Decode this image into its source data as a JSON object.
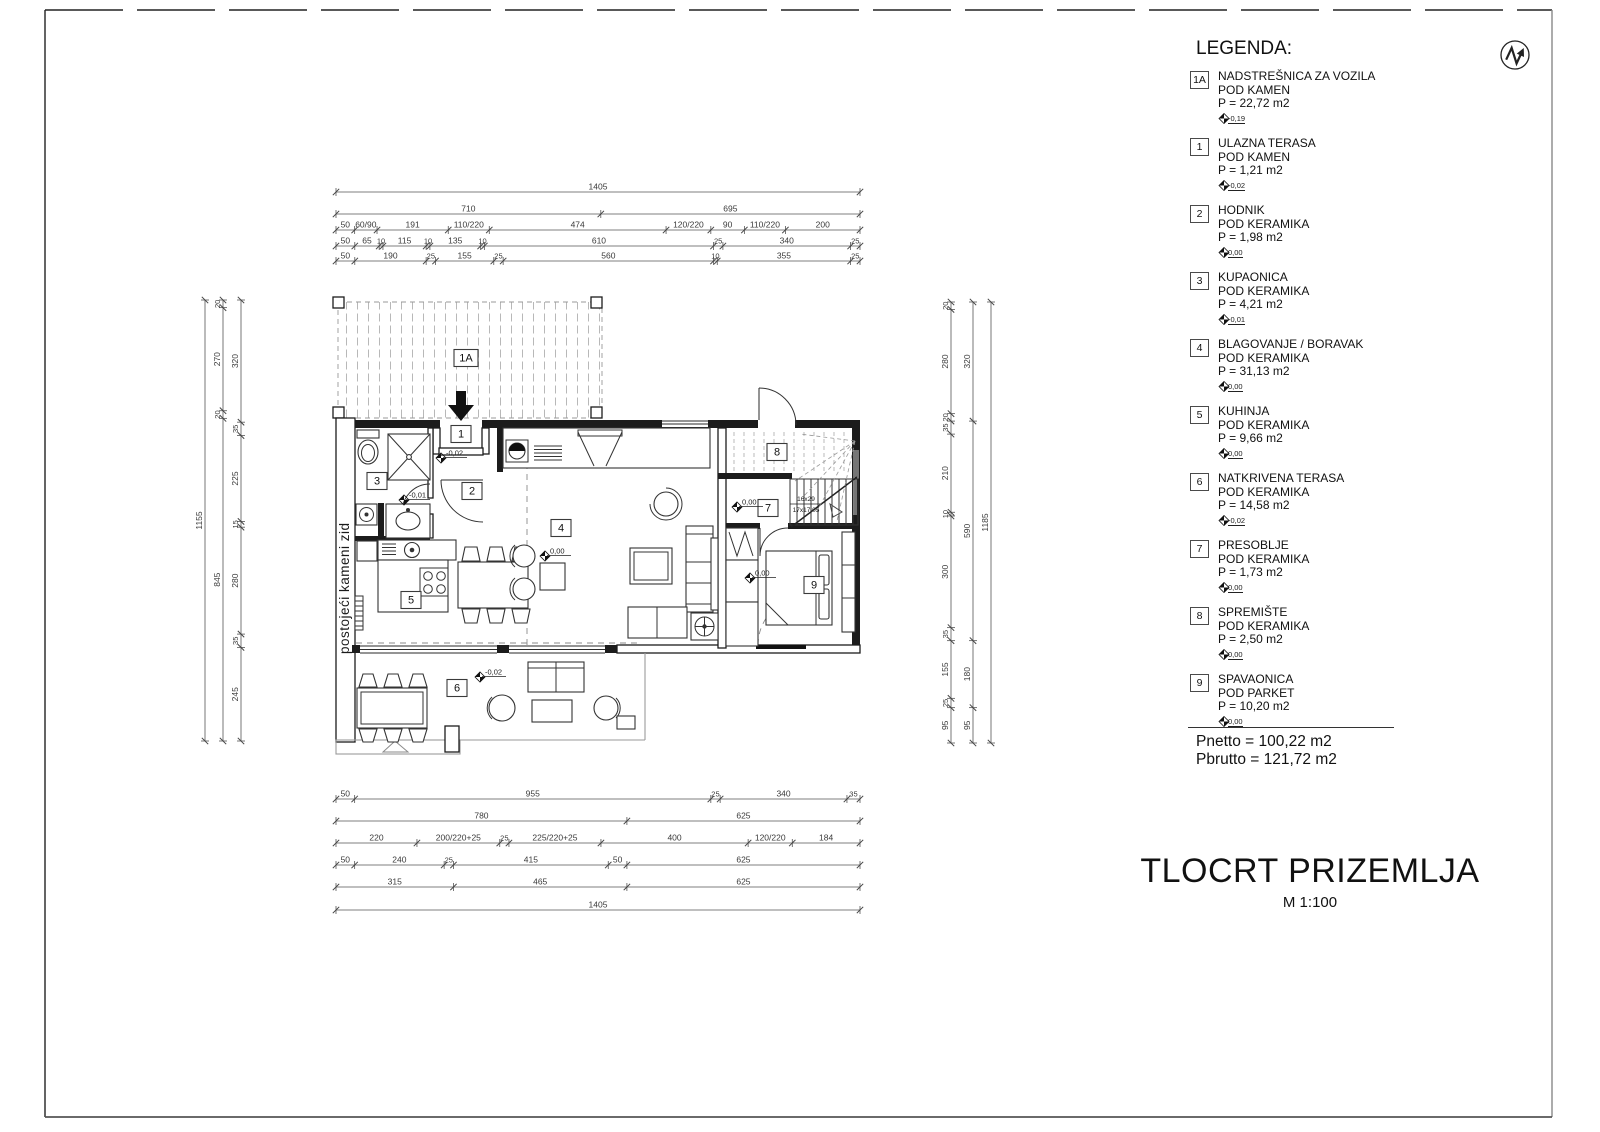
{
  "sheet": {
    "title": "TLOCRT PRIZEMLJA",
    "scale_label": "M 1:100"
  },
  "legend": {
    "heading": "LEGENDA:",
    "entries": [
      {
        "id": "1A",
        "name": "NADSTREŠNICA ZA VOZILA",
        "floor": "POD KAMEN",
        "area": "P = 22,72 m2",
        "elevation": "-0,19"
      },
      {
        "id": "1",
        "name": "ULAZNA TERASA",
        "floor": "POD KAMEN",
        "area": "P = 1,21 m2",
        "elevation": "-0,02"
      },
      {
        "id": "2",
        "name": "HODNIK",
        "floor": "POD KERAMIKA",
        "area": "P = 1,98 m2",
        "elevation": "0,00"
      },
      {
        "id": "3",
        "name": "KUPAONICA",
        "floor": "POD KERAMIKA",
        "area": "P = 4,21 m2",
        "elevation": "-0,01"
      },
      {
        "id": "4",
        "name": "BLAGOVANJE / BORAVAK",
        "floor": "POD KERAMIKA",
        "area": "P = 31,13 m2",
        "elevation": "0,00"
      },
      {
        "id": "5",
        "name": "KUHINJA",
        "floor": "POD KERAMIKA",
        "area": "P = 9,66 m2",
        "elevation": "0,00"
      },
      {
        "id": "6",
        "name": "NATKRIVENA TERASA",
        "floor": "POD KERAMIKA",
        "area": "P = 14,58 m2",
        "elevation": "-0,02"
      },
      {
        "id": "7",
        "name": "PRESOBLJE",
        "floor": "POD KERAMIKA",
        "area": "P = 1,73 m2",
        "elevation": "0,00"
      },
      {
        "id": "8",
        "name": "SPREMIŠTE",
        "floor": "POD KERAMIKA",
        "area": "P = 2,50 m2",
        "elevation": "0,00"
      },
      {
        "id": "9",
        "name": "SPAVAONICA",
        "floor": "POD PARKET",
        "area": "P = 10,20 m2",
        "elevation": "0,00"
      }
    ],
    "totals": {
      "net": "Pnetto = 100,22 m2",
      "gross": "Pbrutto = 121,72 m2"
    }
  },
  "plan": {
    "wall_note": "postojeći kameni zid",
    "stair_note_line1": "16x29",
    "stair_note_line2": "17x17,05",
    "rooms": [
      {
        "id": "1A"
      },
      {
        "id": "1"
      },
      {
        "id": "2"
      },
      {
        "id": "3"
      },
      {
        "id": "4"
      },
      {
        "id": "5"
      },
      {
        "id": "6"
      },
      {
        "id": "7"
      },
      {
        "id": "8"
      },
      {
        "id": "9"
      }
    ],
    "elevations": [
      {
        "label": "-0,02"
      },
      {
        "label": "-0,01"
      },
      {
        "label": "0,00"
      },
      {
        "label": "0,00"
      },
      {
        "label": "0,00"
      },
      {
        "label": "-0,02"
      }
    ]
  },
  "dimensions": {
    "top": [
      {
        "segments": [
          {
            "len": 1405,
            "label": "1405"
          }
        ]
      },
      {
        "segments": [
          {
            "len": 710,
            "label": "710"
          },
          {
            "len": 695,
            "label": "695"
          }
        ]
      },
      {
        "segments": [
          {
            "len": 50,
            "label": "50"
          },
          {
            "len": 60,
            "label": "60/90"
          },
          {
            "len": 191,
            "label": "191"
          },
          {
            "len": 110,
            "label": "110/220"
          },
          {
            "len": 474,
            "label": "474"
          },
          {
            "len": 120,
            "label": "120/220"
          },
          {
            "len": 90,
            "label": "90"
          },
          {
            "len": 110,
            "label": "110/220"
          },
          {
            "len": 200,
            "label": "200"
          }
        ]
      },
      {
        "segments": [
          {
            "len": 50,
            "label": "50"
          },
          {
            "len": 65,
            "label": "65"
          },
          {
            "len": 10,
            "label": "10"
          },
          {
            "len": 115,
            "label": "115"
          },
          {
            "len": 10,
            "label": "10"
          },
          {
            "len": 135,
            "label": "135"
          },
          {
            "len": 10,
            "label": "10"
          },
          {
            "len": 610,
            "label": "610"
          },
          {
            "len": 25,
            "label": "25"
          },
          {
            "len": 340,
            "label": "340"
          },
          {
            "len": 25,
            "label": "25"
          }
        ]
      },
      {
        "segments": [
          {
            "len": 50,
            "label": "50"
          },
          {
            "len": 190,
            "label": "190"
          },
          {
            "len": 25,
            "label": "25"
          },
          {
            "len": 155,
            "label": "155"
          },
          {
            "len": 25,
            "label": "25"
          },
          {
            "len": 560,
            "label": "560"
          },
          {
            "len": 10,
            "label": "10"
          },
          {
            "len": 355,
            "label": "355"
          },
          {
            "len": 25,
            "label": "25"
          }
        ]
      }
    ],
    "bottom": [
      {
        "segments": [
          {
            "len": 50,
            "label": "50"
          },
          {
            "len": 955,
            "label": "955"
          },
          {
            "len": 25,
            "label": "25"
          },
          {
            "len": 340,
            "label": "340"
          },
          {
            "len": 35,
            "label": "35"
          }
        ]
      },
      {
        "segments": [
          {
            "len": 780,
            "label": "780"
          },
          {
            "len": 625,
            "label": "625"
          }
        ]
      },
      {
        "segments": [
          {
            "len": 220,
            "label": "220"
          },
          {
            "len": 225,
            "label": "200/220+25"
          },
          {
            "len": 25,
            "label": "25"
          },
          {
            "len": 250,
            "label": "225/220+25"
          },
          {
            "len": 400,
            "label": "400"
          },
          {
            "len": 120,
            "label": "120/220"
          },
          {
            "len": 184,
            "label": "184"
          }
        ]
      },
      {
        "segments": [
          {
            "len": 50,
            "label": "50"
          },
          {
            "len": 240,
            "label": "240"
          },
          {
            "len": 25,
            "label": "25"
          },
          {
            "len": 415,
            "label": "415"
          },
          {
            "len": 50,
            "label": "50"
          },
          {
            "len": 625,
            "label": "625"
          }
        ]
      },
      {
        "segments": [
          {
            "len": 315,
            "label": "315"
          },
          {
            "len": 465,
            "label": "465"
          },
          {
            "len": 625,
            "label": "625"
          }
        ]
      },
      {
        "segments": [
          {
            "len": 1405,
            "label": "1405"
          }
        ]
      }
    ],
    "left": [
      {
        "segments": [
          {
            "len": 1155,
            "label": "1155"
          }
        ]
      },
      {
        "segments": [
          {
            "len": 20,
            "label": "20"
          },
          {
            "len": 270,
            "label": "270"
          },
          {
            "len": 20,
            "label": "20"
          },
          {
            "len": 845,
            "label": "845"
          }
        ]
      },
      {
        "segments": [
          {
            "len": 320,
            "label": "320"
          },
          {
            "len": 35,
            "label": "35"
          },
          {
            "len": 225,
            "label": "225"
          },
          {
            "len": 15,
            "label": "15"
          },
          {
            "len": 280,
            "label": "280"
          },
          {
            "len": 35,
            "label": "35"
          },
          {
            "len": 245,
            "label": "245"
          }
        ]
      }
    ],
    "right": [
      {
        "segments": [
          {
            "len": 20,
            "label": "20"
          },
          {
            "len": 280,
            "label": "280"
          },
          {
            "len": 20,
            "label": "20"
          },
          {
            "len": 35,
            "label": "35"
          },
          {
            "len": 210,
            "label": "210"
          },
          {
            "len": 10,
            "label": "10"
          },
          {
            "len": 300,
            "label": "300"
          },
          {
            "len": 35,
            "label": "35"
          },
          {
            "len": 155,
            "label": "155"
          },
          {
            "len": 25,
            "label": "25"
          },
          {
            "len": 95,
            "label": "95"
          }
        ]
      },
      {
        "segments": [
          {
            "len": 320,
            "label": "320"
          },
          {
            "len": 590,
            "label": "590"
          },
          {
            "len": 180,
            "label": "180"
          },
          {
            "len": 95,
            "label": "95"
          }
        ]
      },
      {
        "segments": [
          {
            "len": 1185,
            "label": "1185"
          }
        ]
      }
    ]
  },
  "colors": {
    "line": "#1a1a1a",
    "dim": "#555555",
    "hatch": "#b8b8b8"
  }
}
